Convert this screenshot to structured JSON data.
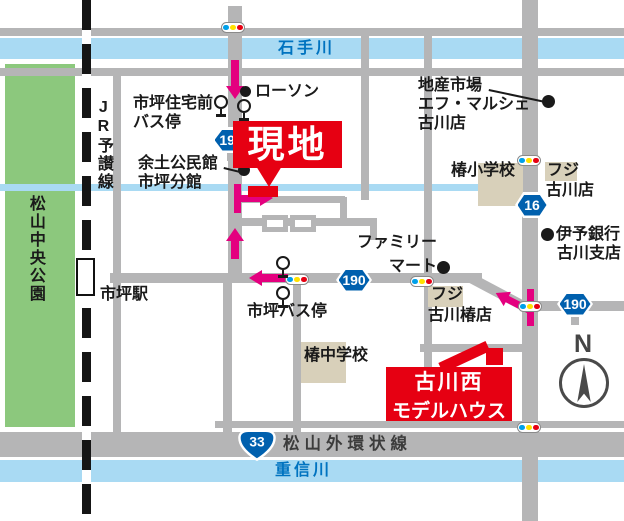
{
  "rivers": {
    "ishite": "石手川",
    "shigenobu": "重信川"
  },
  "park_name": "松山中央公園",
  "railway_name": "JR予讃線",
  "station_name": "市坪駅",
  "road_names": {
    "gaikanjo": "松山外環状線"
  },
  "badges": {
    "r190": "190",
    "r16": "16",
    "r33": "33"
  },
  "pois": {
    "lawson": "ローソン",
    "jutakumae_1": "市坪住宅前",
    "jutakumae_2": "バス停",
    "yodo_1": "余土公民館",
    "yodo_2": "市坪分館",
    "chisan_1": "地産市場",
    "chisan_2": "エフ・マルシェ",
    "chisan_3": "古川店",
    "tsubaki_es": "椿小学校",
    "fuji_furukawa_1": "フジ",
    "fuji_furukawa_2": "古川店",
    "iyo_1": "伊予銀行",
    "iyo_2": "古川支店",
    "famima_1": "ファミリー",
    "famima_2": "マート",
    "fuji_tsubaki_1": "フジ",
    "fuji_tsubaki_2": "古川椿店",
    "ichitsubo_bus": "市坪バス停",
    "tsubaki_jhs": "椿中学校"
  },
  "markers": {
    "genchi": "現地",
    "model_1": "古川西",
    "model_2": "モデルハウス"
  },
  "compass_n": "N",
  "colors": {
    "road": "#b5b5b6",
    "river": "#a9daf3",
    "park": "#8cc87d",
    "building": "#d8d0ba",
    "red": "#e60012",
    "route_pink": "#e4007f",
    "badge_blue": "#0060ae",
    "signal_blue": "#00a0e9",
    "signal_yellow": "#ffe100",
    "signal_red": "#e60012"
  }
}
